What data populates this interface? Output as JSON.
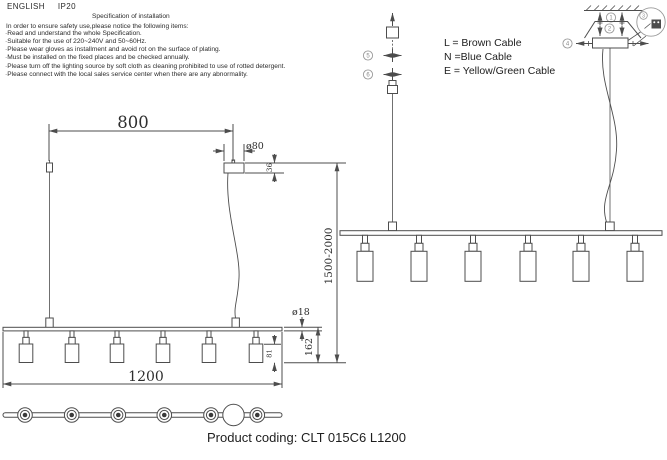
{
  "header": {
    "language": "ENGLISH",
    "ip_rating": "IP20"
  },
  "spec": {
    "title": "Specification of installation",
    "intro": "In order to ensure safety use,please notice the following items:",
    "items": [
      "Read and understand the whole Specification.",
      "Suitable for the use of 220~240V and 50~60Hz.",
      "Please wear gloves as installment and avoid rot on the surface of plating.",
      "Must be installed on the fixed places and be checked annually.",
      "Please turn off the lighting source by soft cloth as cleaning prohibited to use of rotted detergent.",
      "Please connect with the local sales service center when there are any abnormality."
    ]
  },
  "legend": {
    "line_l": "L = Brown Cable",
    "line_n": "N =Blue Cable",
    "line_e": "E = Yellow/Green Cable"
  },
  "dimensions": {
    "suspension_spacing": "800",
    "canopy_diameter": "ø80",
    "canopy_height": "36",
    "drop_range": "1500-2000",
    "bar_length": "1200",
    "bar_diameter": "ø18",
    "lamp_drop": "162",
    "shade_height": "81"
  },
  "callouts": {
    "c1": "1",
    "c2": "2",
    "c3": "3",
    "c4": "4",
    "c5": "5",
    "c6": "6"
  },
  "footer": {
    "product_coding": "Product coding: CLT 015C6 L1200"
  },
  "colors": {
    "line": "#4d4d4d",
    "text": "#2b2b2b",
    "background": "#ffffff"
  }
}
